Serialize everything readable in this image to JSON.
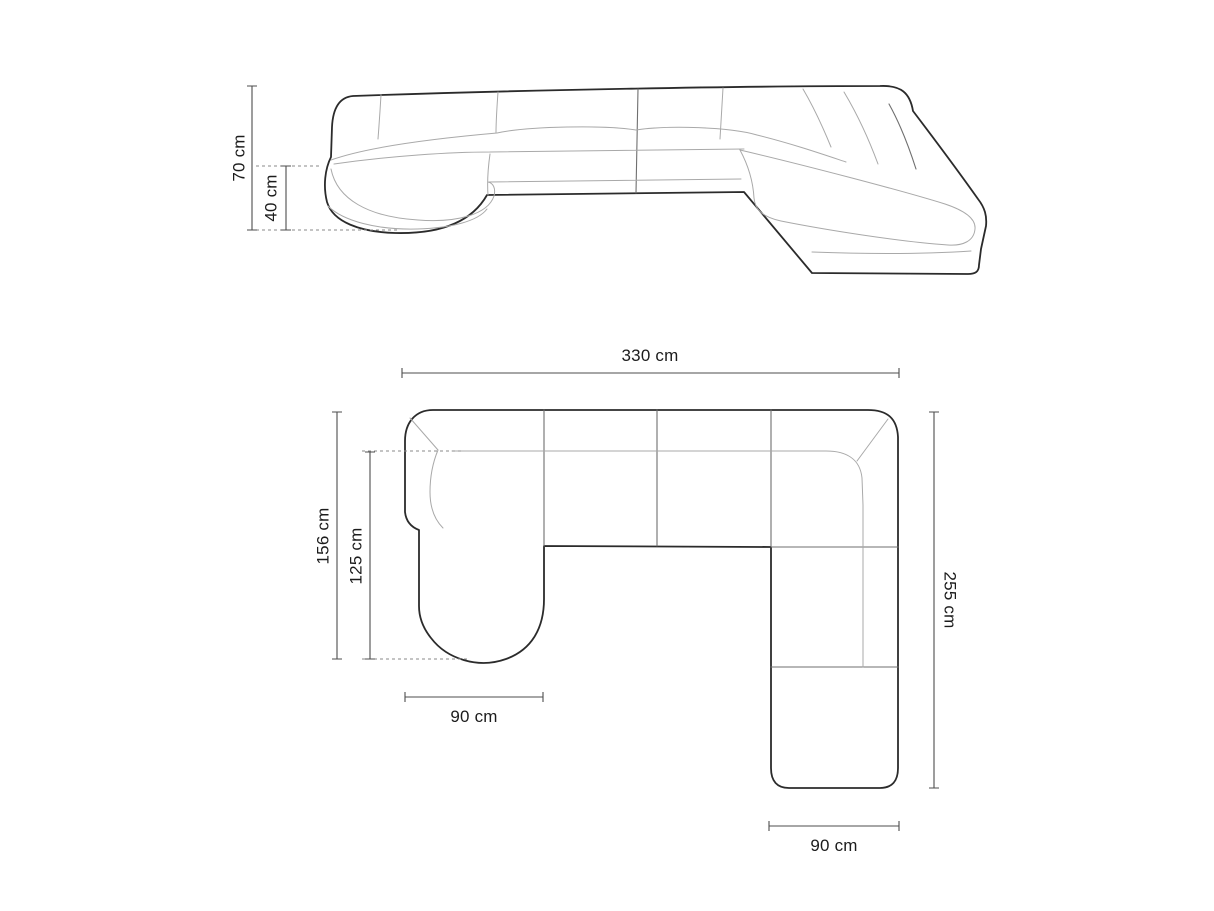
{
  "diagram": {
    "type": "sofa-dimension-drawing",
    "views": {
      "front_view": {
        "name": "front elevation",
        "total_height_label": "70 cm",
        "seat_height_label": "40 cm"
      },
      "top_view": {
        "name": "top plan",
        "total_width_label": "330 cm",
        "left_depth_label": "156 cm",
        "chaise_inner_depth_label": "125 cm",
        "chaise_width_label": "90 cm",
        "right_depth_label": "255 cm",
        "end_module_width_label": "90 cm"
      }
    },
    "colors": {
      "background": "#ffffff",
      "outline": "#2b2b2b",
      "seam": "#a9a9a9",
      "dimension_line": "#4d4d4d",
      "dashed_line": "#8a8a8a",
      "text": "#1c1c1c"
    }
  }
}
